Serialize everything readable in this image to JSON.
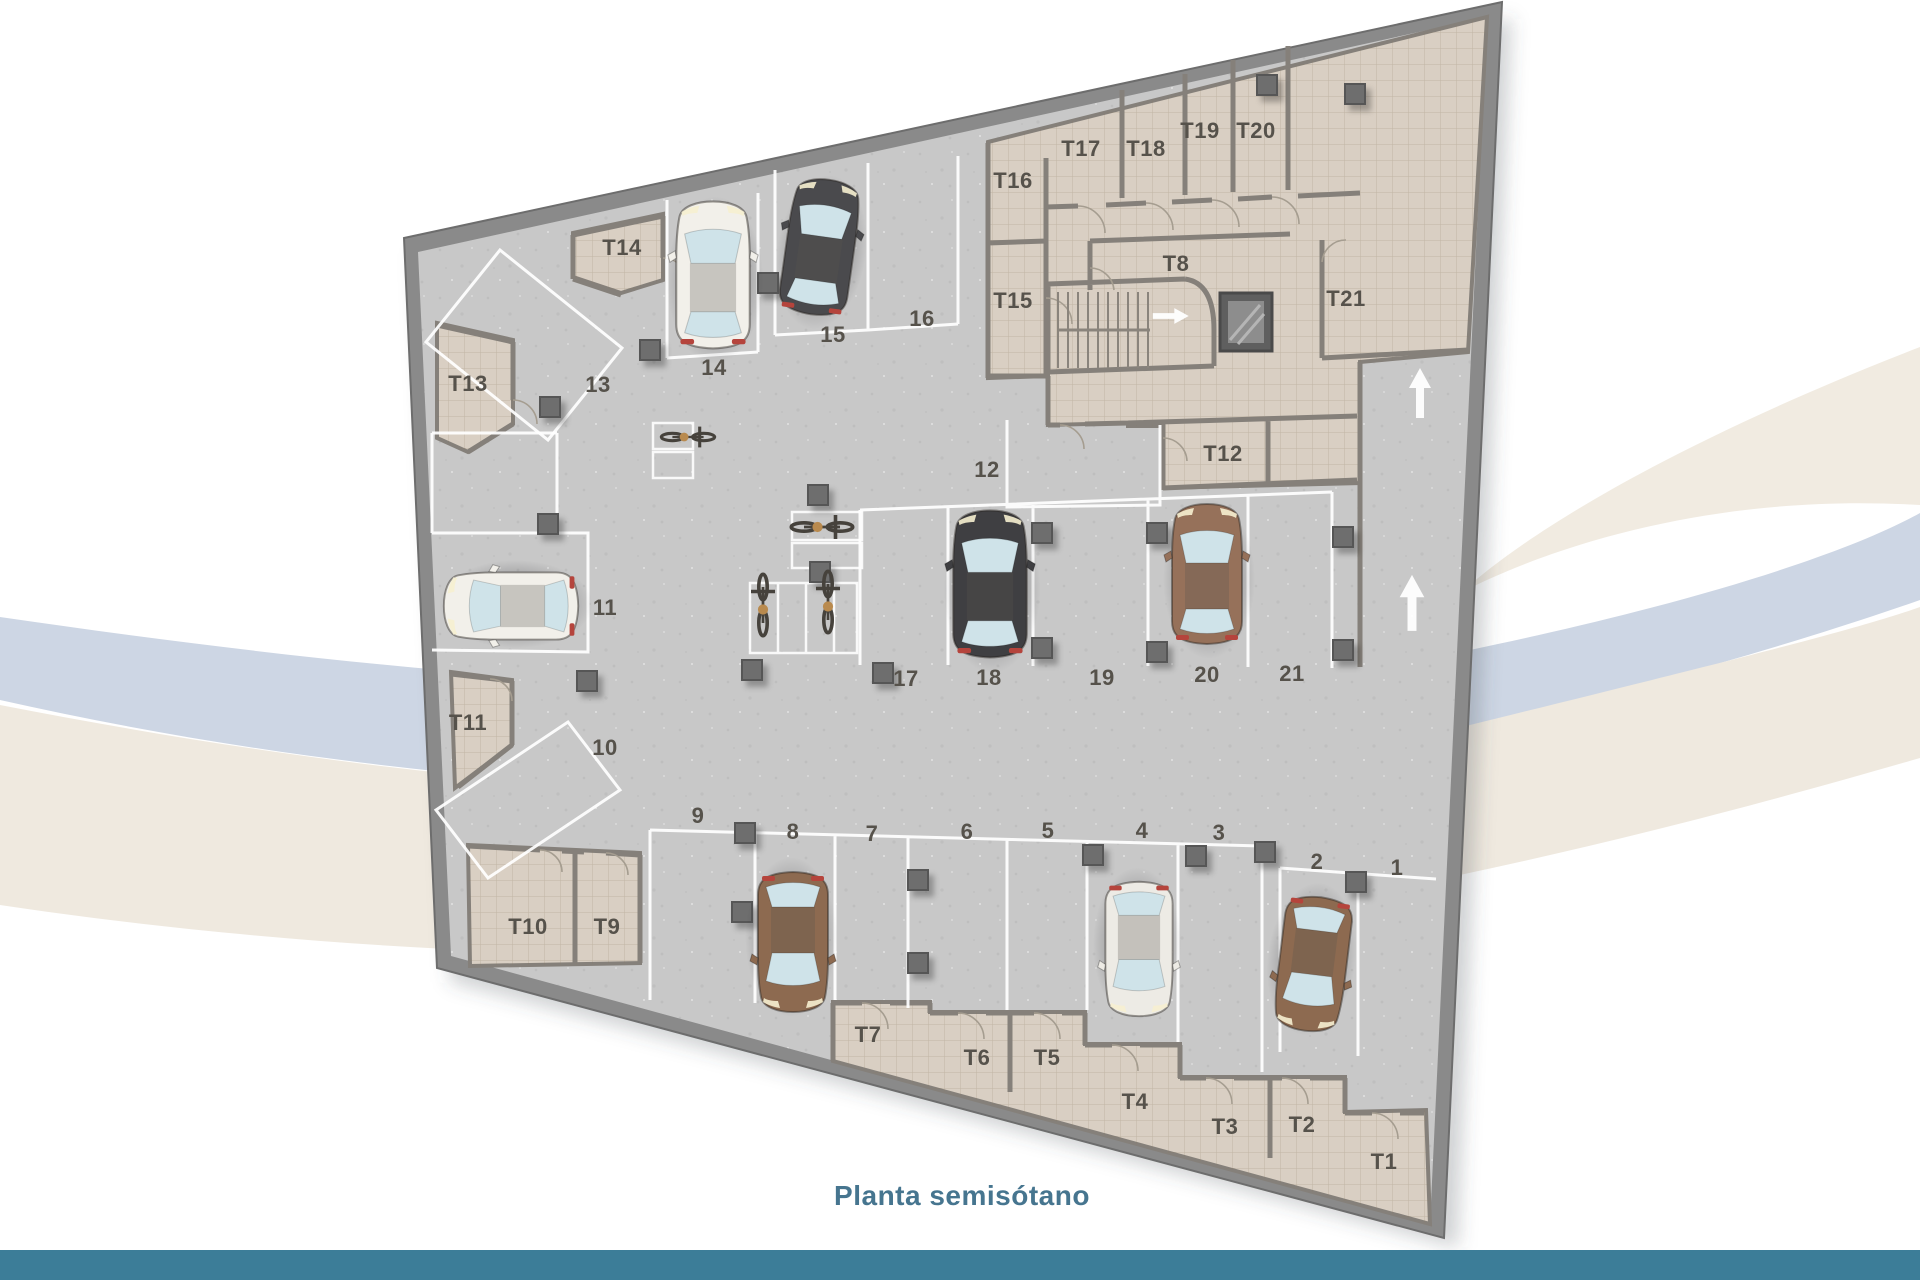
{
  "title": {
    "text": "Planta semisótano"
  },
  "colors": {
    "accent_bar": "#3c7d98",
    "title_text": "#46758f",
    "floor": "#c8c8c8",
    "storage_tile": "#d9cfc3",
    "outer_wall": "#8a8a8a",
    "swoosh_cream": "#f1ebe1",
    "swoosh_blue": "#cdd6e4",
    "parking_line": "#ffffff"
  },
  "plan": {
    "name": "Planta semisótano",
    "parking_spaces": {
      "p1": "1",
      "p2": "2",
      "p3": "3",
      "p4": "4",
      "p5": "5",
      "p6": "6",
      "p7": "7",
      "p8": "8",
      "p9": "9",
      "p10": "10",
      "p11": "11",
      "p12": "12",
      "p13": "13",
      "p14": "14",
      "p15": "15",
      "p16": "16",
      "p17": "17",
      "p18": "18",
      "p19": "19",
      "p20": "20",
      "p21": "21"
    },
    "storage_rooms": {
      "t1": "T1",
      "t2": "T2",
      "t3": "T3",
      "t4": "T4",
      "t5": "T5",
      "t6": "T6",
      "t7": "T7",
      "t8": "T8",
      "t9": "T9",
      "t10": "T10",
      "t11": "T11",
      "t12": "T12",
      "t13": "T13",
      "t14": "T14",
      "t15": "T15",
      "t16": "T16",
      "t17": "T17",
      "t18": "T18",
      "t19": "T19",
      "t20": "T20",
      "t21": "T21"
    }
  }
}
